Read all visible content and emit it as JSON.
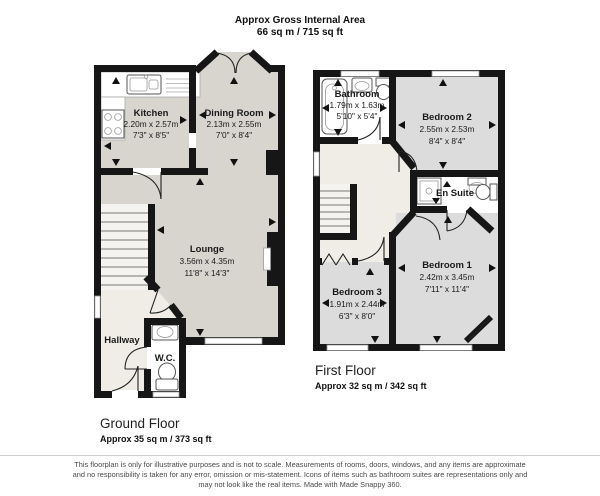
{
  "header": {
    "line1": "Approx Gross Internal Area",
    "line2": "66 sq m / 715 sq ft"
  },
  "ground_floor": {
    "title": "Ground Floor",
    "area": "Approx 35 sq m / 373 sq ft",
    "rooms": {
      "kitchen": {
        "name": "Kitchen",
        "metric": "2.20m x 2.57m",
        "imperial": "7'3\" x 8'5\""
      },
      "dining_room": {
        "name": "Dining Room",
        "metric": "2.13m x 2.55m",
        "imperial": "7'0\" x 8'4\""
      },
      "lounge": {
        "name": "Lounge",
        "metric": "3.56m x 4.35m",
        "imperial": "11'8\" x 14'3\""
      },
      "hallway": {
        "name": "Hallway"
      },
      "wc": {
        "name": "W.C."
      }
    }
  },
  "first_floor": {
    "title": "First Floor",
    "area": "Approx 32 sq m / 342 sq ft",
    "rooms": {
      "bathroom": {
        "name": "Bathroom",
        "metric": "1.79m x 1.63m",
        "imperial": "5'10\" x 5'4\""
      },
      "bedroom2": {
        "name": "Bedroom 2",
        "metric": "2.55m x 2.53m",
        "imperial": "8'4\" x 8'4\""
      },
      "en_suite": {
        "name": "En Suite"
      },
      "bedroom1": {
        "name": "Bedroom 1",
        "metric": "2.42m x 3.45m",
        "imperial": "7'11\" x 11'4\""
      },
      "bedroom3": {
        "name": "Bedroom 3",
        "metric": "1.91m x 2.44m",
        "imperial": "6'3\" x 8'0\""
      }
    }
  },
  "disclaimer": {
    "lines": [
      "This floorplan is only for illustrative purposes and is not to scale. Measurements of rooms, doors, windows, and any items are approximate",
      "and no responsibility is taken for any error, omission or mis-statement. Icons of items such as bathroom suites are representations only and",
      "may not look like the real items. Made with Made Snappy 360."
    ]
  },
  "colors": {
    "wall": "#161616",
    "floor_ground": "#d8d5cf",
    "floor_bedroom": "#dcdcdc",
    "floor_hall": "#f0ede7",
    "floor_wet": "#ffffff",
    "text": "#1a1a1a"
  }
}
